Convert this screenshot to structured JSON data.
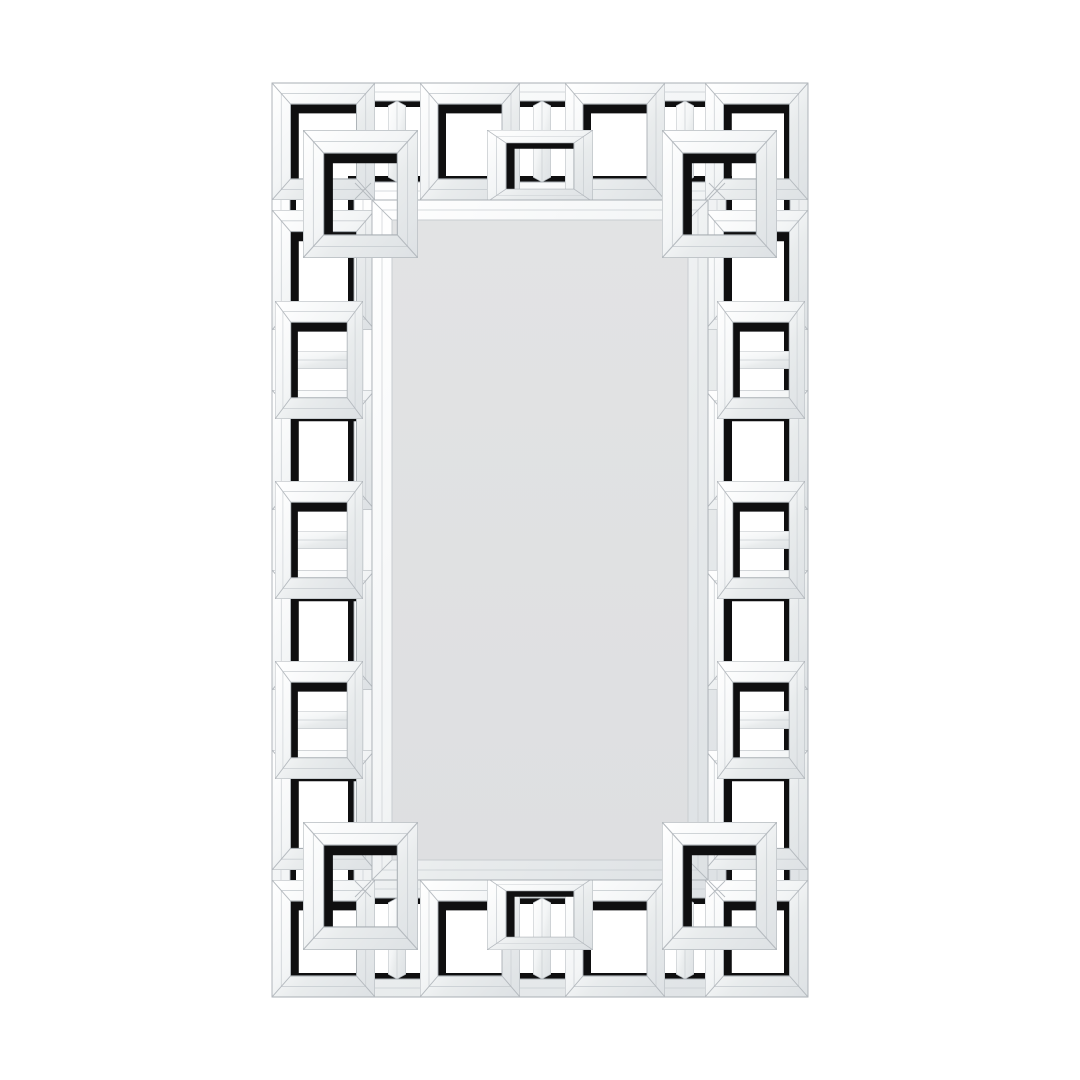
{
  "scene": {
    "type": "product-photo",
    "alt": "Rectangular wall mirror with an ornate mirrored Greek key fretwork frame, photographed flat on a plain white background",
    "background_color": "#ffffff"
  },
  "product": {
    "kind": "wall mirror",
    "frame_style": "interlocking Greek key / meander squares made of beveled mirror strips",
    "orientation": "portrait rectangle",
    "plate_shape": "rectangle with beveled mirror border"
  },
  "colors": {
    "background": "#ffffff",
    "mirror_strip_light": "#ffffff",
    "mirror_strip_mid": "#eef1f2",
    "mirror_strip_dark": "#dde1e4",
    "strip_edge_line": "#a9afb4",
    "strip_seam_line": "#c9ced2",
    "backing_black": "#0f0f10",
    "mirror_plate": "#dfe0e1",
    "mirror_plate_edge": "#c8ccd0"
  }
}
